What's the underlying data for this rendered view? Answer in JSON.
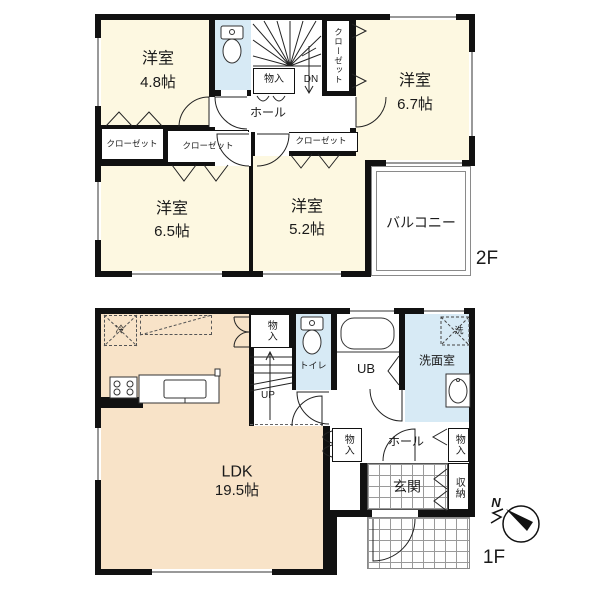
{
  "floor2": {
    "floor_label": "2F",
    "room_48_name": "洋室",
    "room_48_size": "4.8帖",
    "room_67_name": "洋室",
    "room_67_size": "6.7帖",
    "room_65_name": "洋室",
    "room_65_size": "6.5帖",
    "room_52_name": "洋室",
    "room_52_size": "5.2帖",
    "balcony": "バルコニー",
    "hall": "ホール",
    "storage": "物入",
    "stairs_direction": "DN",
    "closet_left": "クローゼット",
    "closet_center": "クローゼット",
    "closet_52": "クローゼット",
    "closet_side": "クローゼット"
  },
  "floor1": {
    "floor_label": "1F",
    "ldk_name": "LDK",
    "ldk_size": "19.5帖",
    "fridge": "冷",
    "storage_top": "物入",
    "toilet": "トイレ",
    "bath": "UB",
    "washroom": "洗面室",
    "washer": "洗",
    "stairs_direction": "UP",
    "hall": "ホール",
    "storage_hall_left": "物入",
    "storage_hall_right": "物入",
    "entrance": "玄関",
    "shoe_storage": "収納"
  },
  "compass": {
    "north": "N"
  },
  "colors": {
    "room_fill": "#fdf8e1",
    "ldk_fill": "#f8e3c8",
    "wet_fill": "#d7eaf5",
    "wall": "#111111"
  }
}
